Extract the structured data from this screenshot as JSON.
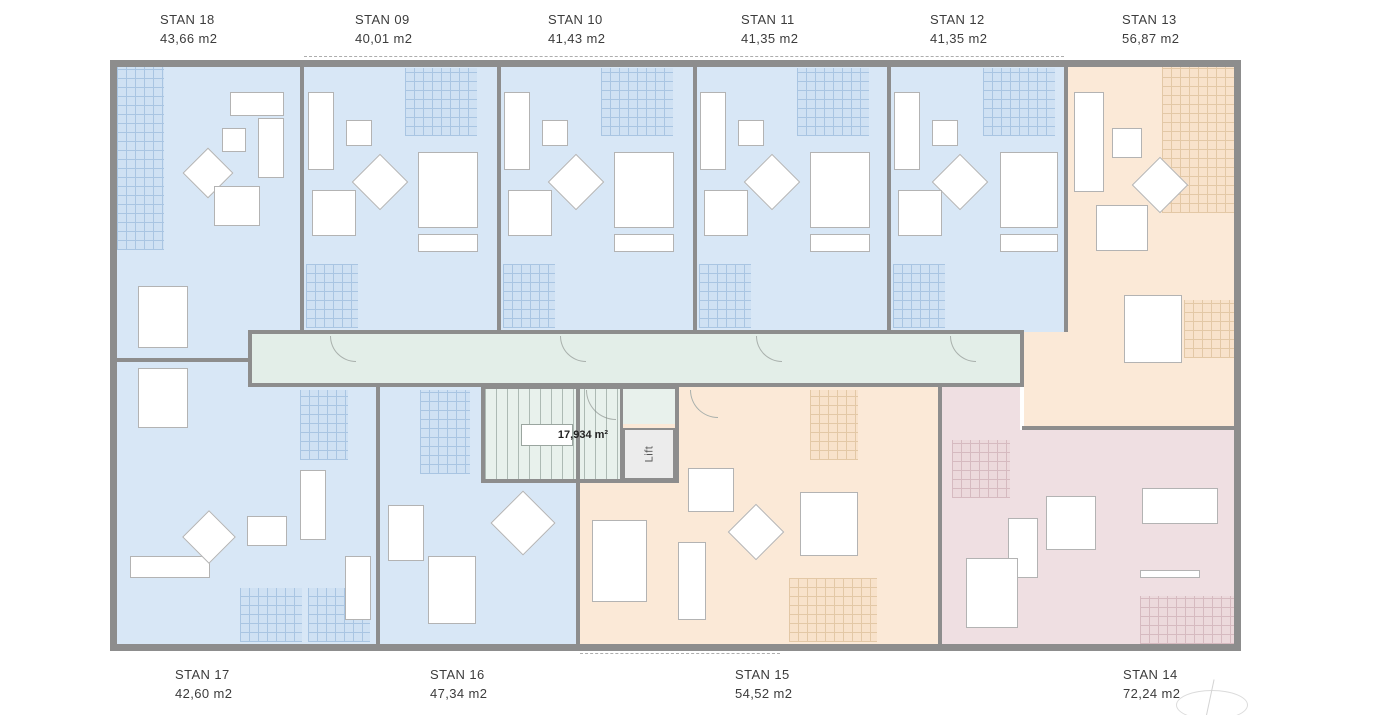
{
  "core": {
    "stair_area_label": "17,934 m²",
    "lift_label": "Lift"
  },
  "colors": {
    "blue": "#d8e7f6",
    "blue_grid_fill": "#cfe1f3",
    "blue_grid_line": "#a9c5e2",
    "peach": "#fbe9d7",
    "peach_grid_fill": "#f8e2cb",
    "peach_grid_line": "#e3c8a6",
    "mauve": "#efdfe2",
    "mauve_grid_fill": "#ecd9dc",
    "mauve_grid_line": "#d6bac0",
    "corridor": "#e3eee8",
    "stair": "#e8f1ec",
    "wall": "#8d8d8d",
    "text": "#3c3c3c"
  },
  "top_labels": [
    {
      "name": "STAN 18",
      "area": "43,66 m2",
      "x": 160
    },
    {
      "name": "STAN 09",
      "area": "40,01 m2",
      "x": 355
    },
    {
      "name": "STAN 10",
      "area": "41,43 m2",
      "x": 548
    },
    {
      "name": "STAN 11",
      "area": "41,35 m2",
      "x": 741
    },
    {
      "name": "STAN 12",
      "area": "41,35 m2",
      "x": 930
    },
    {
      "name": "STAN 13",
      "area": "56,87 m2",
      "x": 1122
    }
  ],
  "bottom_labels": [
    {
      "name": "STAN 17",
      "area": "42,60 m2",
      "x": 175
    },
    {
      "name": "STAN 16",
      "area": "47,34 m2",
      "x": 430
    },
    {
      "name": "STAN 15",
      "area": "54,52 m2",
      "x": 735
    },
    {
      "name": "STAN 14",
      "area": "72,24 m2",
      "x": 1123
    }
  ],
  "regions": [
    {
      "n": "stan-18",
      "f": "blue",
      "x": 117,
      "y": 67,
      "w": 183,
      "h": 291
    },
    {
      "n": "stan-09",
      "f": "blue",
      "x": 304,
      "y": 67,
      "w": 193,
      "h": 265
    },
    {
      "n": "stan-10",
      "f": "blue",
      "x": 501,
      "y": 67,
      "w": 192,
      "h": 265
    },
    {
      "n": "stan-11",
      "f": "blue",
      "x": 697,
      "y": 67,
      "w": 190,
      "h": 265
    },
    {
      "n": "stan-12",
      "f": "blue",
      "x": 891,
      "y": 67,
      "w": 173,
      "h": 265
    },
    {
      "n": "stan-13",
      "f": "peach",
      "x": 1068,
      "y": 67,
      "w": 166,
      "h": 265
    },
    {
      "n": "stan-13-lower",
      "f": "peach",
      "x": 1024,
      "y": 332,
      "w": 210,
      "h": 94
    },
    {
      "n": "stan-17-upper",
      "f": "blue",
      "x": 117,
      "y": 362,
      "w": 131,
      "h": 282
    },
    {
      "n": "stan-17",
      "f": "blue",
      "x": 248,
      "y": 387,
      "w": 128,
      "h": 257
    },
    {
      "n": "stan-16",
      "f": "blue",
      "x": 380,
      "y": 387,
      "w": 196,
      "h": 257
    },
    {
      "n": "stan-15",
      "f": "peach",
      "x": 580,
      "y": 387,
      "w": 358,
      "h": 257
    },
    {
      "n": "stan-14-upper",
      "f": "mauve",
      "x": 942,
      "y": 387,
      "w": 78,
      "h": 43
    },
    {
      "n": "stan-14",
      "f": "mauve",
      "x": 942,
      "y": 430,
      "w": 292,
      "h": 214
    },
    {
      "n": "corridor",
      "f": "corridor",
      "x": 252,
      "y": 334,
      "w": 768,
      "h": 51
    },
    {
      "n": "stair-core",
      "f": "stair",
      "x": 485,
      "y": 389,
      "w": 135,
      "h": 90
    },
    {
      "n": "lift-lobby",
      "f": "stair",
      "x": 623,
      "y": 389,
      "w": 52,
      "h": 35
    }
  ],
  "grids": [
    {
      "t": "blue",
      "x": 117,
      "y": 67,
      "w": 47,
      "h": 183
    },
    {
      "t": "blue",
      "x": 405,
      "y": 68,
      "w": 72,
      "h": 68
    },
    {
      "t": "blue",
      "x": 601,
      "y": 68,
      "w": 72,
      "h": 68
    },
    {
      "t": "blue",
      "x": 797,
      "y": 68,
      "w": 72,
      "h": 68
    },
    {
      "t": "blue",
      "x": 983,
      "y": 68,
      "w": 72,
      "h": 68
    },
    {
      "t": "peach",
      "x": 1162,
      "y": 67,
      "w": 72,
      "h": 146
    },
    {
      "t": "blue",
      "x": 306,
      "y": 264,
      "w": 52,
      "h": 64
    },
    {
      "t": "blue",
      "x": 503,
      "y": 264,
      "w": 52,
      "h": 64
    },
    {
      "t": "blue",
      "x": 699,
      "y": 264,
      "w": 52,
      "h": 64
    },
    {
      "t": "blue",
      "x": 893,
      "y": 264,
      "w": 52,
      "h": 64
    },
    {
      "t": "blue",
      "x": 300,
      "y": 390,
      "w": 48,
      "h": 70
    },
    {
      "t": "blue",
      "x": 420,
      "y": 390,
      "w": 50,
      "h": 84
    },
    {
      "t": "peach",
      "x": 810,
      "y": 390,
      "w": 48,
      "h": 70
    },
    {
      "t": "peach",
      "x": 1184,
      "y": 300,
      "w": 50,
      "h": 58
    },
    {
      "t": "mauve",
      "x": 952,
      "y": 440,
      "w": 58,
      "h": 58
    },
    {
      "t": "blue",
      "x": 240,
      "y": 588,
      "w": 62,
      "h": 54
    },
    {
      "t": "blue",
      "x": 308,
      "y": 588,
      "w": 62,
      "h": 54
    },
    {
      "t": "peach",
      "x": 789,
      "y": 578,
      "w": 88,
      "h": 64
    },
    {
      "t": "mauve",
      "x": 1140,
      "y": 596,
      "w": 94,
      "h": 48
    }
  ],
  "walls": [
    {
      "x": 110,
      "y": 60,
      "w": 1131,
      "h": 7
    },
    {
      "x": 110,
      "y": 644,
      "w": 1131,
      "h": 7
    },
    {
      "x": 110,
      "y": 60,
      "w": 7,
      "h": 591
    },
    {
      "x": 1234,
      "y": 60,
      "w": 7,
      "h": 591
    },
    {
      "x": 300,
      "y": 64,
      "w": 4,
      "h": 268
    },
    {
      "x": 497,
      "y": 64,
      "w": 4,
      "h": 268
    },
    {
      "x": 693,
      "y": 64,
      "w": 4,
      "h": 268
    },
    {
      "x": 887,
      "y": 64,
      "w": 4,
      "h": 268
    },
    {
      "x": 1064,
      "y": 64,
      "w": 4,
      "h": 268
    },
    {
      "x": 248,
      "y": 330,
      "w": 776,
      "h": 4
    },
    {
      "x": 248,
      "y": 383,
      "w": 776,
      "h": 4
    },
    {
      "x": 248,
      "y": 330,
      "w": 4,
      "h": 57
    },
    {
      "x": 1020,
      "y": 330,
      "w": 4,
      "h": 57
    },
    {
      "x": 376,
      "y": 385,
      "w": 4,
      "h": 261
    },
    {
      "x": 576,
      "y": 385,
      "w": 4,
      "h": 261
    },
    {
      "x": 938,
      "y": 385,
      "w": 4,
      "h": 261
    },
    {
      "x": 114,
      "y": 358,
      "w": 136,
      "h": 4
    },
    {
      "x": 1022,
      "y": 426,
      "w": 214,
      "h": 4
    },
    {
      "x": 481,
      "y": 385,
      "w": 198,
      "h": 4
    },
    {
      "x": 481,
      "y": 479,
      "w": 198,
      "h": 4
    },
    {
      "x": 481,
      "y": 385,
      "w": 4,
      "h": 98
    },
    {
      "x": 675,
      "y": 385,
      "w": 4,
      "h": 98
    },
    {
      "x": 620,
      "y": 389,
      "w": 3,
      "h": 92
    }
  ],
  "furniture": [
    {
      "t": "r",
      "x": 230,
      "y": 92,
      "w": 54,
      "h": 24
    },
    {
      "t": "r",
      "x": 258,
      "y": 118,
      "w": 26,
      "h": 60
    },
    {
      "t": "r",
      "x": 222,
      "y": 128,
      "w": 24,
      "h": 24
    },
    {
      "t": "d",
      "x": 190,
      "y": 155,
      "s": 36
    },
    {
      "t": "r",
      "x": 214,
      "y": 186,
      "w": 46,
      "h": 40
    },
    {
      "t": "r",
      "x": 138,
      "y": 286,
      "w": 50,
      "h": 62
    },
    {
      "t": "r",
      "x": 308,
      "y": 92,
      "w": 26,
      "h": 78
    },
    {
      "t": "r",
      "x": 346,
      "y": 120,
      "w": 26,
      "h": 26
    },
    {
      "t": "d",
      "x": 360,
      "y": 162,
      "s": 40
    },
    {
      "t": "r",
      "x": 312,
      "y": 190,
      "w": 44,
      "h": 46
    },
    {
      "t": "r",
      "x": 418,
      "y": 152,
      "w": 60,
      "h": 76
    },
    {
      "t": "r",
      "x": 418,
      "y": 234,
      "w": 60,
      "h": 18
    },
    {
      "t": "r",
      "x": 504,
      "y": 92,
      "w": 26,
      "h": 78
    },
    {
      "t": "r",
      "x": 542,
      "y": 120,
      "w": 26,
      "h": 26
    },
    {
      "t": "d",
      "x": 556,
      "y": 162,
      "s": 40
    },
    {
      "t": "r",
      "x": 508,
      "y": 190,
      "w": 44,
      "h": 46
    },
    {
      "t": "r",
      "x": 614,
      "y": 152,
      "w": 60,
      "h": 76
    },
    {
      "t": "r",
      "x": 614,
      "y": 234,
      "w": 60,
      "h": 18
    },
    {
      "t": "r",
      "x": 700,
      "y": 92,
      "w": 26,
      "h": 78
    },
    {
      "t": "r",
      "x": 738,
      "y": 120,
      "w": 26,
      "h": 26
    },
    {
      "t": "d",
      "x": 752,
      "y": 162,
      "s": 40
    },
    {
      "t": "r",
      "x": 704,
      "y": 190,
      "w": 44,
      "h": 46
    },
    {
      "t": "r",
      "x": 810,
      "y": 152,
      "w": 60,
      "h": 76
    },
    {
      "t": "r",
      "x": 810,
      "y": 234,
      "w": 60,
      "h": 18
    },
    {
      "t": "r",
      "x": 894,
      "y": 92,
      "w": 26,
      "h": 78
    },
    {
      "t": "r",
      "x": 932,
      "y": 120,
      "w": 26,
      "h": 26
    },
    {
      "t": "d",
      "x": 940,
      "y": 162,
      "s": 40
    },
    {
      "t": "r",
      "x": 898,
      "y": 190,
      "w": 44,
      "h": 46
    },
    {
      "t": "r",
      "x": 1000,
      "y": 152,
      "w": 58,
      "h": 76
    },
    {
      "t": "r",
      "x": 1000,
      "y": 234,
      "w": 58,
      "h": 18
    },
    {
      "t": "r",
      "x": 1074,
      "y": 92,
      "w": 30,
      "h": 100
    },
    {
      "t": "r",
      "x": 1112,
      "y": 128,
      "w": 30,
      "h": 30
    },
    {
      "t": "d",
      "x": 1140,
      "y": 165,
      "s": 40
    },
    {
      "t": "r",
      "x": 1096,
      "y": 205,
      "w": 52,
      "h": 46
    },
    {
      "t": "r",
      "x": 1124,
      "y": 295,
      "w": 58,
      "h": 68
    },
    {
      "t": "r",
      "x": 138,
      "y": 368,
      "w": 50,
      "h": 60
    },
    {
      "t": "r",
      "x": 130,
      "y": 556,
      "w": 80,
      "h": 22
    },
    {
      "t": "d",
      "x": 190,
      "y": 518,
      "s": 38
    },
    {
      "t": "r",
      "x": 247,
      "y": 516,
      "w": 40,
      "h": 30
    },
    {
      "t": "r",
      "x": 300,
      "y": 470,
      "w": 26,
      "h": 70
    },
    {
      "t": "r",
      "x": 345,
      "y": 556,
      "w": 26,
      "h": 64
    },
    {
      "t": "d",
      "x": 500,
      "y": 500,
      "s": 46
    },
    {
      "t": "r",
      "x": 428,
      "y": 556,
      "w": 48,
      "h": 68
    },
    {
      "t": "r",
      "x": 388,
      "y": 505,
      "w": 36,
      "h": 56
    },
    {
      "t": "r",
      "x": 592,
      "y": 520,
      "w": 55,
      "h": 82
    },
    {
      "t": "r",
      "x": 678,
      "y": 542,
      "w": 28,
      "h": 78
    },
    {
      "t": "d",
      "x": 736,
      "y": 512,
      "s": 40
    },
    {
      "t": "r",
      "x": 688,
      "y": 468,
      "w": 46,
      "h": 44
    },
    {
      "t": "r",
      "x": 800,
      "y": 492,
      "w": 58,
      "h": 64
    },
    {
      "t": "r",
      "x": 1008,
      "y": 518,
      "w": 30,
      "h": 60
    },
    {
      "t": "r",
      "x": 1046,
      "y": 496,
      "w": 50,
      "h": 54
    },
    {
      "t": "r",
      "x": 1142,
      "y": 488,
      "w": 76,
      "h": 36
    },
    {
      "t": "r",
      "x": 1140,
      "y": 570,
      "w": 60,
      "h": 8
    },
    {
      "t": "r",
      "x": 966,
      "y": 558,
      "w": 52,
      "h": 70
    }
  ],
  "arcs": [
    {
      "x": 330,
      "y": 336,
      "s": 26
    },
    {
      "x": 560,
      "y": 336,
      "s": 26
    },
    {
      "x": 756,
      "y": 336,
      "s": 26
    },
    {
      "x": 950,
      "y": 336,
      "s": 26
    },
    {
      "x": 586,
      "y": 390,
      "s": 30
    },
    {
      "x": 690,
      "y": 390,
      "s": 28
    }
  ],
  "dashes": [
    {
      "x": 304,
      "y": 56,
      "w": 760
    },
    {
      "x": 580,
      "y": 653,
      "w": 200
    }
  ]
}
